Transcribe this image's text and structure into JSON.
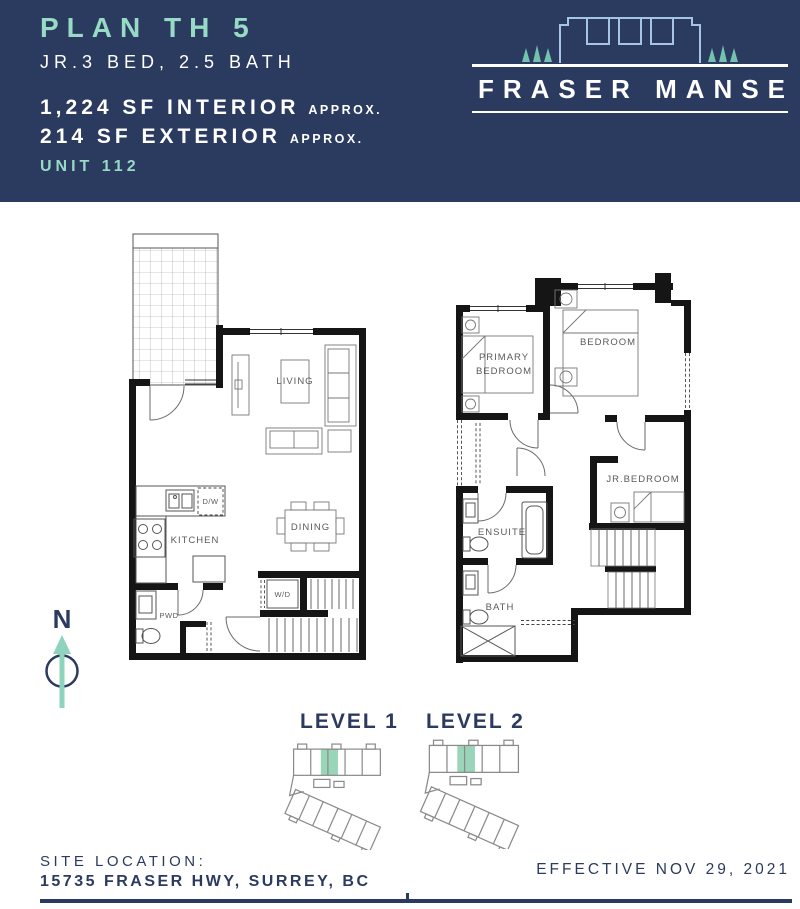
{
  "colors": {
    "navy": "#2b3a5f",
    "teal": "#97dbc6",
    "arrow_teal": "#8ed3bb",
    "highlight": "#8fd0b2",
    "logo_blue": "#a6c4e6",
    "tree_teal": "#72c2ae"
  },
  "header": {
    "plan_title": "PLAN TH 5",
    "plan_subtitle": "JR.3 BED, 2.5 BATH",
    "interior_sf": "1,224 SF INTERIOR",
    "interior_approx": "APPROX.",
    "exterior_sf": "214 SF EXTERIOR",
    "exterior_approx": "APPROX.",
    "unit": "UNIT 112",
    "brand": "FRASER MANSE"
  },
  "compass": {
    "north": "N"
  },
  "plans": {
    "level1": {
      "living": "LIVING",
      "kitchen": "KITCHEN",
      "dining": "DINING",
      "dishwasher": "D/W",
      "powder": "PWD",
      "washer_dryer": "W/D"
    },
    "level2": {
      "primary_line1": "PRIMARY",
      "primary_line2": "BEDROOM",
      "bedroom": "BEDROOM",
      "jr_bedroom": "JR.BEDROOM",
      "ensuite": "ENSUITE",
      "bath": "BATH"
    }
  },
  "keyplans": {
    "level1": "LEVEL 1",
    "level2": "LEVEL 2"
  },
  "footer": {
    "site_location_label": "SITE LOCATION:",
    "site_address": "15735 FRASER HWY, SURREY, BC",
    "effective_date": "EFFECTIVE NOV 29, 2021"
  }
}
